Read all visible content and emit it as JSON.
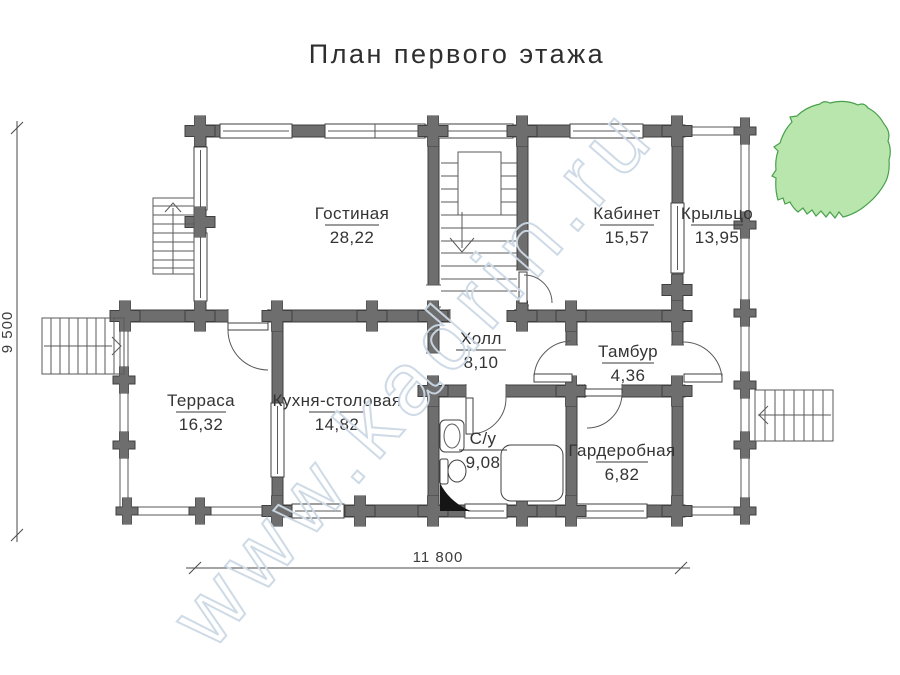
{
  "title": "План первого этажа",
  "watermark": "www.kadrin.ru",
  "dimensions": {
    "vertical": "9 500",
    "horizontal": "11 800"
  },
  "rooms": [
    {
      "name": "Гостиная",
      "area": "28,22"
    },
    {
      "name": "Кабинет",
      "area": "15,57"
    },
    {
      "name": "Крыльцо",
      "area": "13,95"
    },
    {
      "name": "Холл",
      "area": "8,10"
    },
    {
      "name": "Тамбур",
      "area": "4,36"
    },
    {
      "name": "Терраса",
      "area": "16,32"
    },
    {
      "name": "Кухня-столовая",
      "area": "14,82"
    },
    {
      "name": "С/у",
      "area": "9,08"
    },
    {
      "name": "Гардеробная",
      "area": "6,82"
    }
  ],
  "colors": {
    "wall": "#6e6e6e",
    "wall_outline": "#3f3f3f",
    "thin_line": "#5a5a5a",
    "text": "#343434",
    "watermark": "#ccd9e5",
    "tree_fill": "#b9e6ad",
    "tree_stroke": "#47a04a"
  }
}
